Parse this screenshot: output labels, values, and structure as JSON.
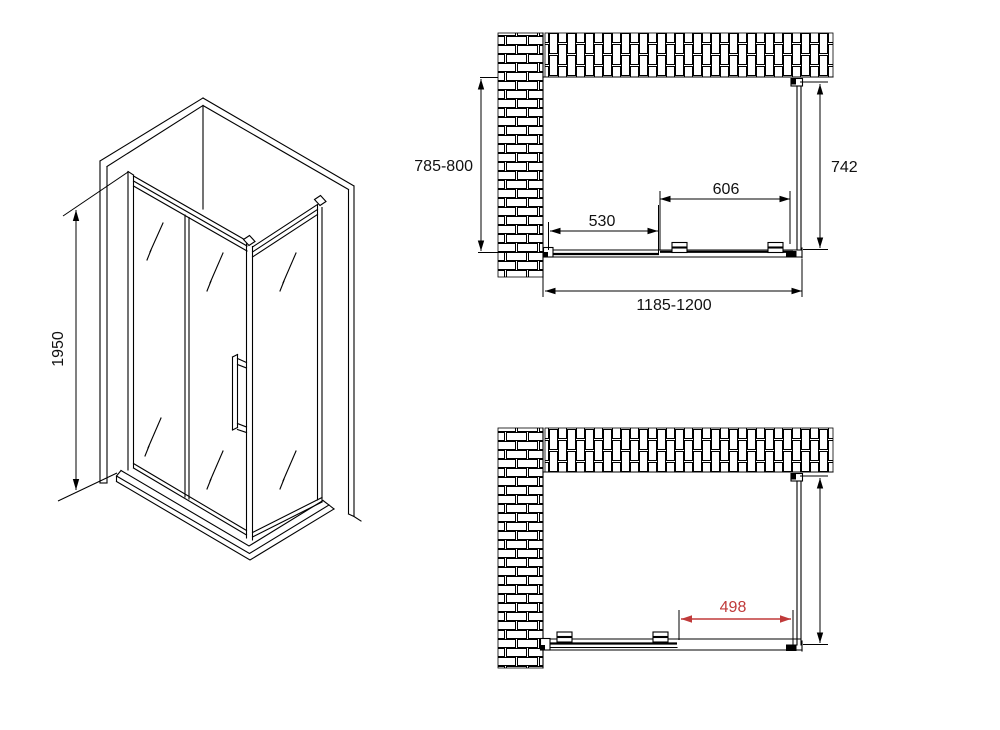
{
  "title": "Shower enclosure technical drawing",
  "colors": {
    "line": "#000000",
    "dimension_red": "#c03a3a",
    "background": "#ffffff"
  },
  "views": {
    "isometric": {
      "name": "isometric-view",
      "dims": {
        "height": "1950"
      }
    },
    "plan_closed": {
      "name": "top-view-door-closed",
      "dims": {
        "depth_range": "785-800",
        "side_panel_depth": "742",
        "door_width": "606",
        "fixed_panel_width": "530",
        "total_width_range": "1185-1200"
      }
    },
    "plan_open": {
      "name": "top-view-door-open",
      "dims": {
        "opening_width": "498"
      }
    }
  }
}
